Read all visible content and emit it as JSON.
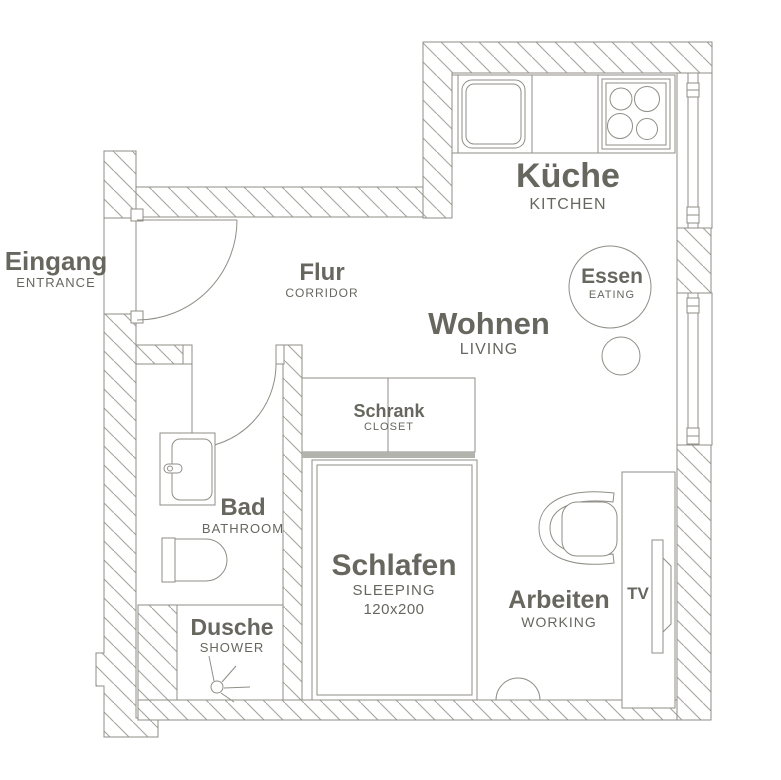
{
  "colors": {
    "line": "#8f8e87",
    "hatch": "#a5a49d",
    "text": "#67675f",
    "bar": "#b3b3ad"
  },
  "rooms": {
    "eingang": {
      "de": "Eingang",
      "en": "ENTRANCE"
    },
    "flur": {
      "de": "Flur",
      "en": "CORRIDOR"
    },
    "kueche": {
      "de": "Küche",
      "en": "KITCHEN"
    },
    "wohnen": {
      "de": "Wohnen",
      "en": "LIVING"
    },
    "essen": {
      "de": "Essen",
      "en": "EATING"
    },
    "bad": {
      "de": "Bad",
      "en": "BATHROOM"
    },
    "dusche": {
      "de": "Dusche",
      "en": "SHOWER"
    },
    "schrank": {
      "de": "Schrank",
      "en": "CLOSET"
    },
    "schlafen": {
      "de": "Schlafen",
      "en": "SLEEPING",
      "size": "120x200"
    },
    "arbeiten": {
      "de": "Arbeiten",
      "en": "WORKING"
    },
    "tv": {
      "label": "TV"
    }
  }
}
